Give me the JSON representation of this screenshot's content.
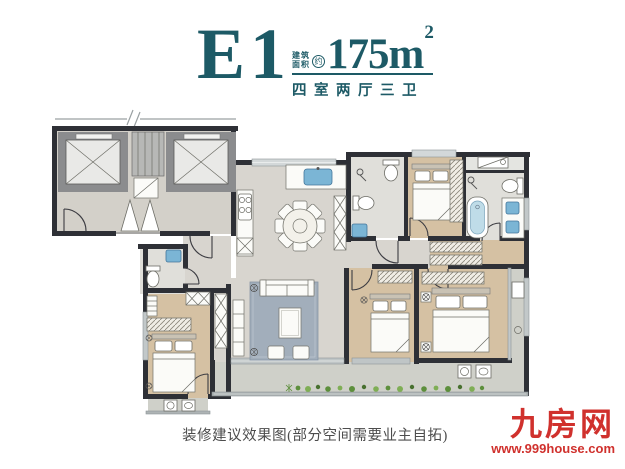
{
  "header": {
    "unit_name": "E1",
    "area_label_line1": "建筑",
    "area_label_line2": "面积",
    "area_approx": "约",
    "area_value": "175m",
    "area_unit_sup": "2",
    "subtitle": "四室两厅三卫"
  },
  "caption": "装修建议效果图(部分空间需要业主自拓)",
  "watermark": {
    "site_name": "九房网",
    "site_url": "www.999house.com"
  },
  "colors": {
    "accent_teal": "#1d5a66",
    "watermark_red": "#d0312d",
    "wall_dark": "#2e3036",
    "wood_floor": "#d5c1a3",
    "marble_floor": "#d8d5cf",
    "tile_floor": "#e0dfda",
    "balcony_floor": "#cfd0c9",
    "rug_blue_gray": "#a2aebb",
    "water_blue": "#7bb5d5",
    "plant_green": "#5d8f3c",
    "caption_gray": "#4c4c4c"
  }
}
